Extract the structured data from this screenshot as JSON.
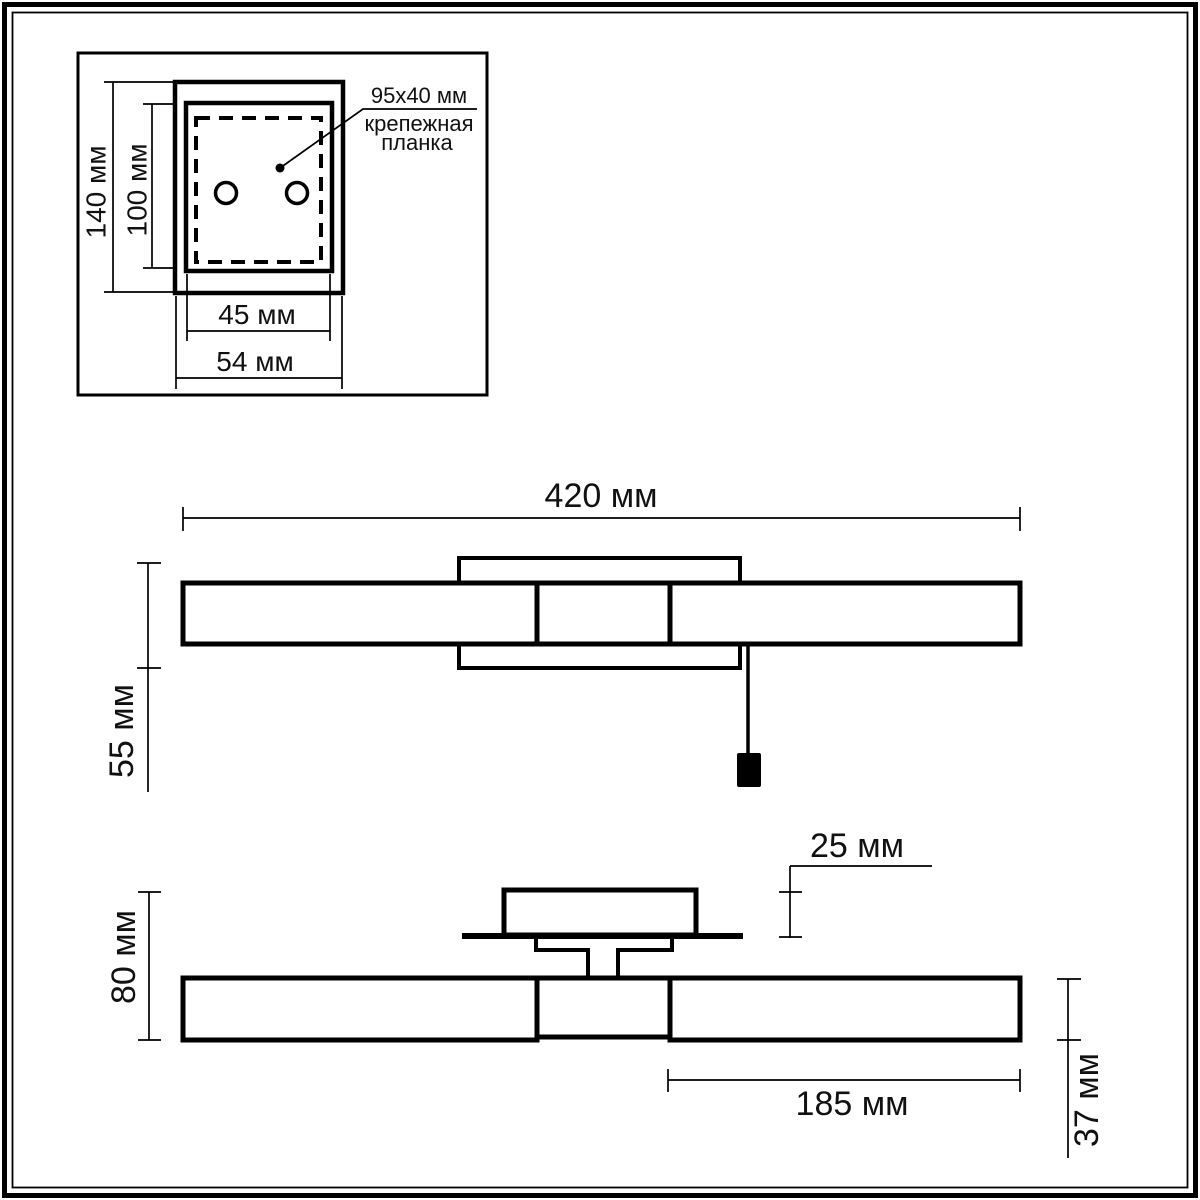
{
  "drawing": {
    "colors": {
      "line": "#000000",
      "background": "#ffffff"
    },
    "detail_view": {
      "dim_outer_height": "140 мм",
      "dim_inner_height": "100 мм",
      "dim_inner_width": "45 мм",
      "dim_outer_width": "54 мм",
      "callout_line1": "95x40 мм",
      "callout_line2": "крепежная",
      "callout_line3": "планка"
    },
    "front_view": {
      "dim_width": "420 мм",
      "dim_height": "55 мм"
    },
    "bottom_view": {
      "dim_overall_height": "80 мм",
      "dim_canopy_height": "25 мм",
      "dim_shade_length": "185 мм",
      "dim_shade_diameter": "37 мм"
    }
  }
}
